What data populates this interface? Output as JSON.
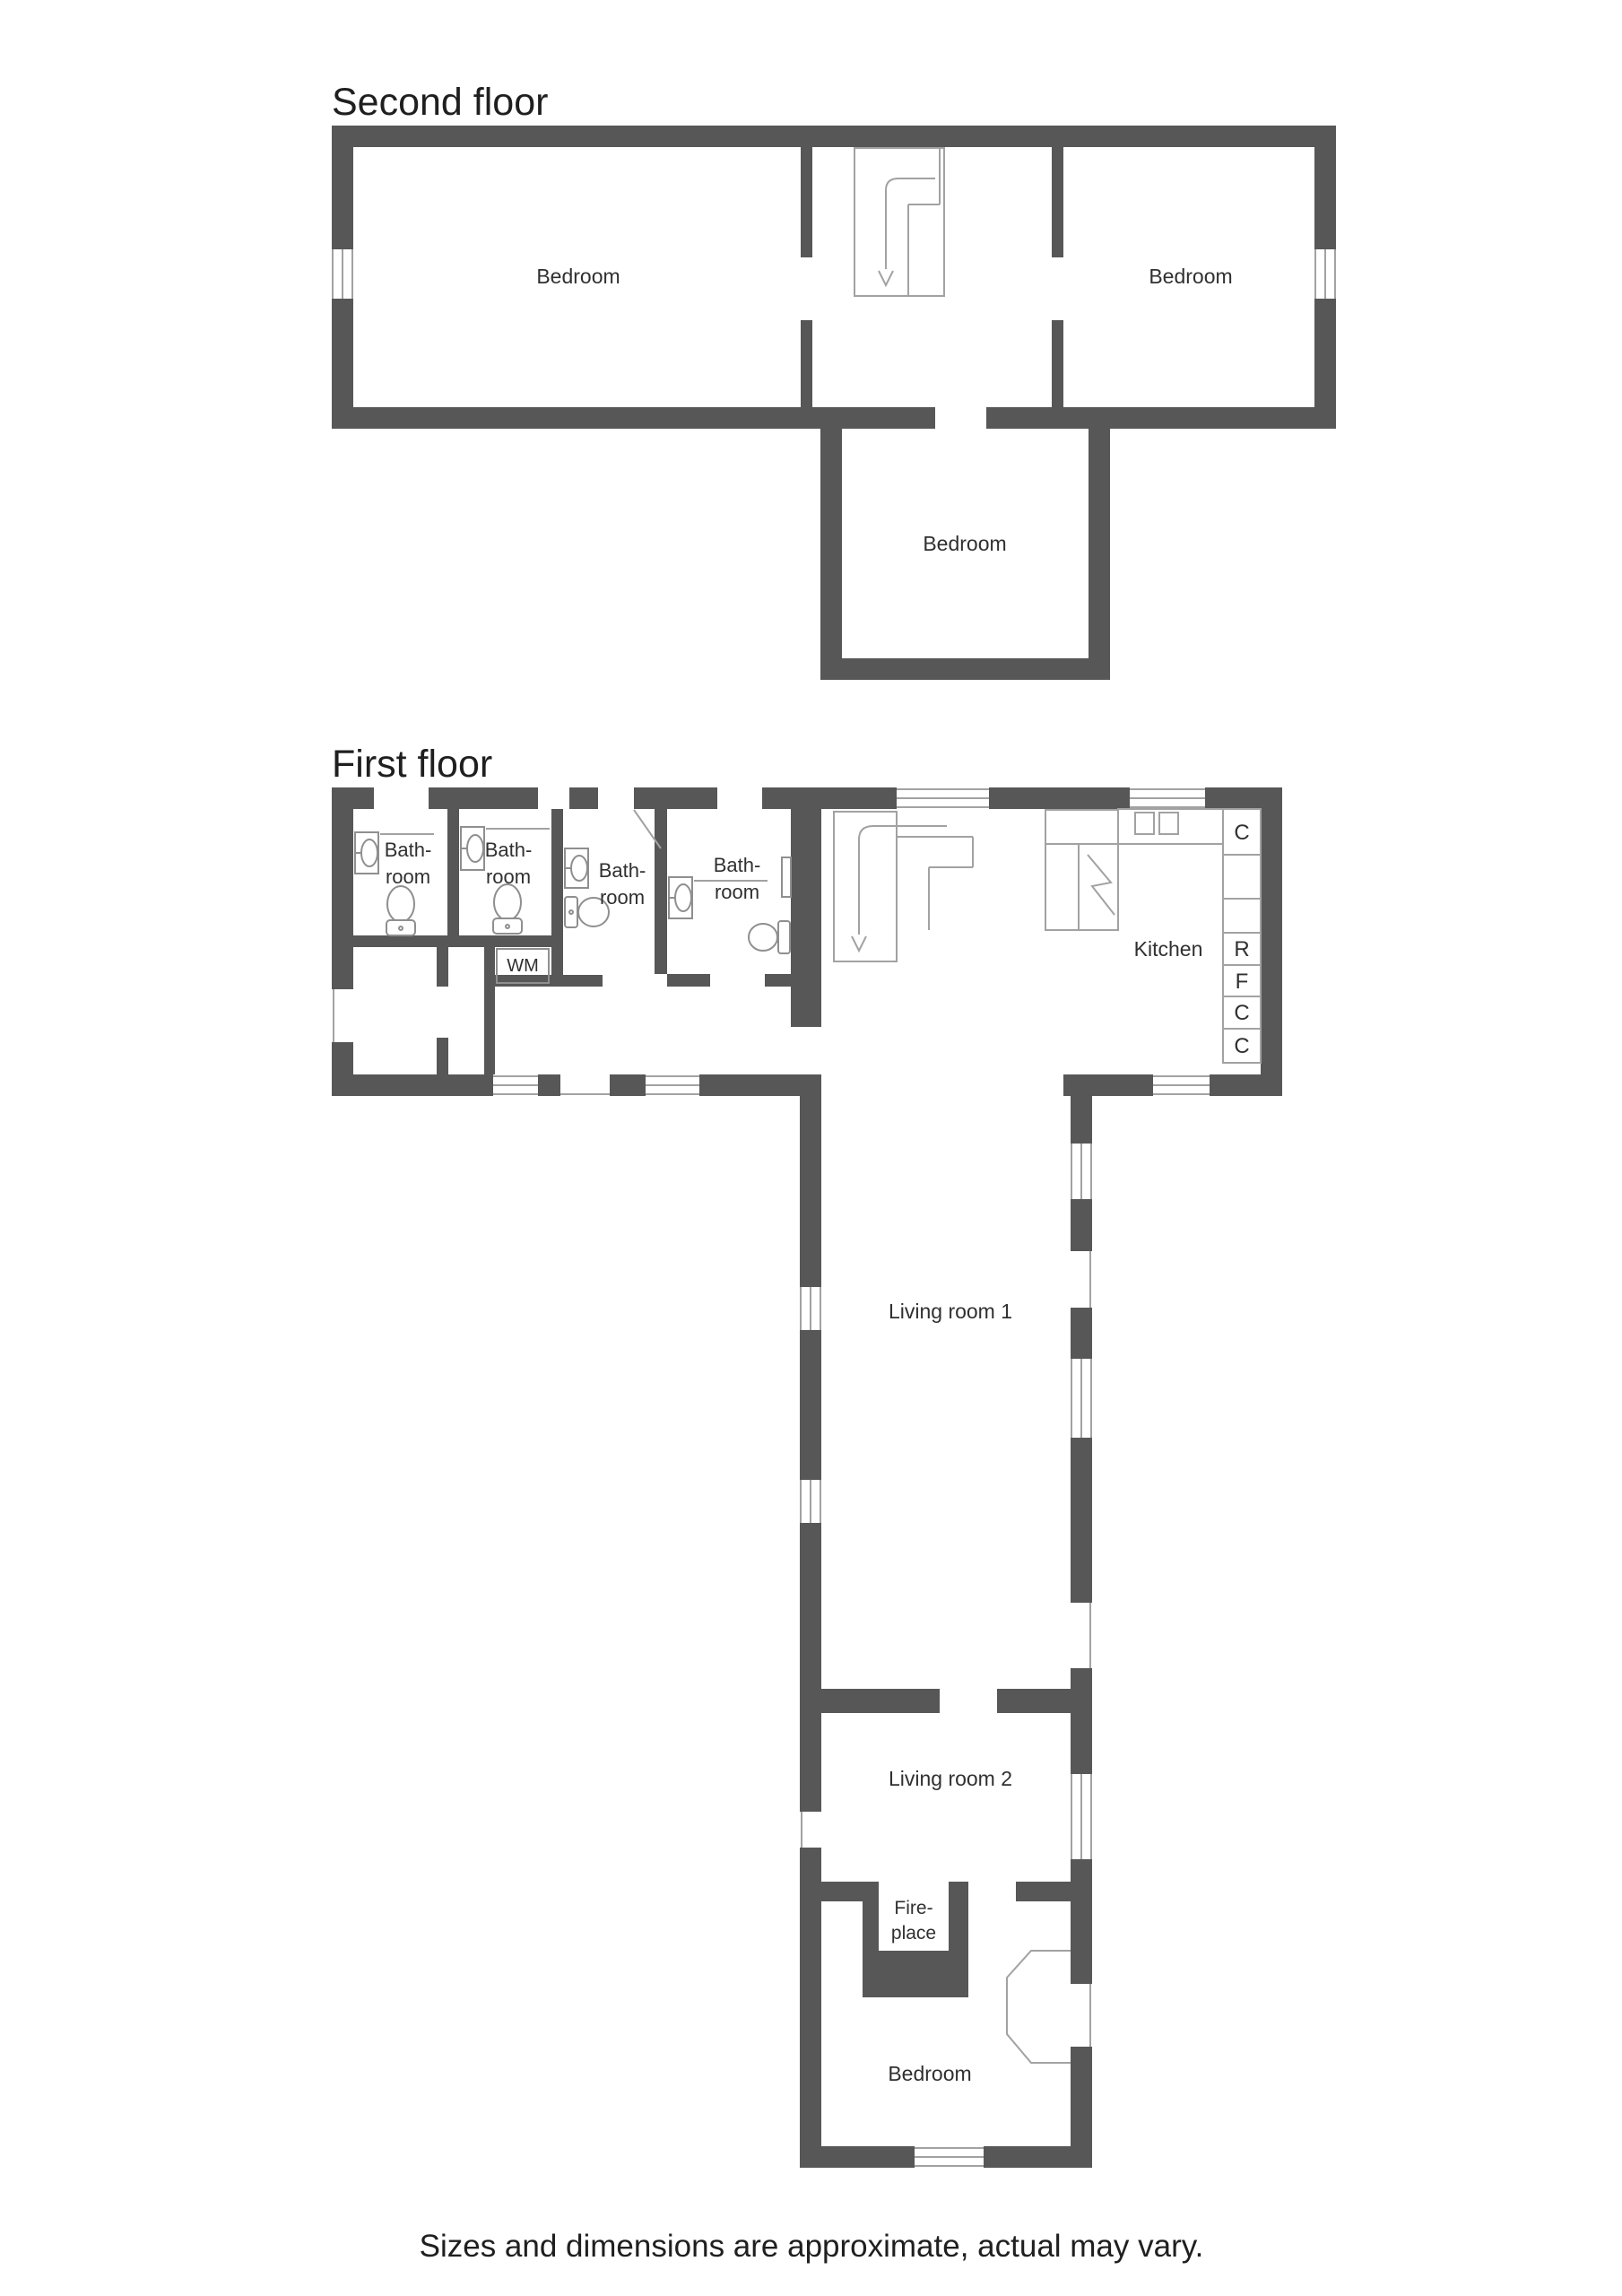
{
  "colors": {
    "wall": "#575757",
    "thin_line": "#a2a2a2",
    "fixture_line": "#8f8f8f",
    "text": "#303030",
    "title": "#1f1f1f",
    "background": "#ffffff"
  },
  "second_floor": {
    "title": "Second floor",
    "bedroom_left": "Bedroom",
    "bedroom_right": "Bedroom",
    "bedroom_lower": "Bedroom"
  },
  "first_floor": {
    "title": "First floor",
    "bathrooms": [
      {
        "line1": "Bath-",
        "line2": "room"
      },
      {
        "line1": "Bath-",
        "line2": "room"
      },
      {
        "line1": "Bath-",
        "line2": "room"
      },
      {
        "line1": "Bath-",
        "line2": "room"
      }
    ],
    "wm": "WM",
    "kitchen": {
      "label": "Kitchen",
      "units": [
        "C",
        "",
        "",
        "R",
        "F",
        "C",
        "C"
      ]
    },
    "living_room_1": "Living room 1",
    "living_room_2": "Living room 2",
    "fireplace": {
      "line1": "Fire-",
      "line2": "place"
    },
    "bedroom": "Bedroom"
  },
  "disclaimer": "Sizes and dimensions are approximate, actual may vary."
}
